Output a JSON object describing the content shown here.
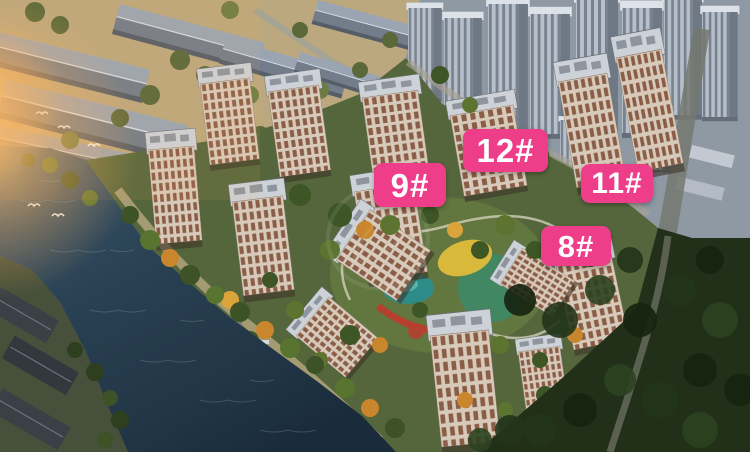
{
  "building_labels": [
    {
      "id": "9",
      "label": "9#"
    },
    {
      "id": "12",
      "label": "12#"
    },
    {
      "id": "11",
      "label": "11#"
    },
    {
      "id": "8",
      "label": "8#"
    }
  ],
  "colors": {
    "badge-bg": "#EE3E8A",
    "badge-text": "#FFFFFF",
    "river": "#2C4557",
    "land-warm": "#BCA87E",
    "estate-green": "#55663C",
    "forest": "#22301A",
    "highrise-zone": "#8E99A4",
    "facade": "#D8CABB",
    "window-stripe": "#8A5E46",
    "pond": "#2E8C88",
    "playground-yellow": "#D9B93C",
    "path-red": "#B5402F",
    "glow-orange": "#FFB45E"
  }
}
